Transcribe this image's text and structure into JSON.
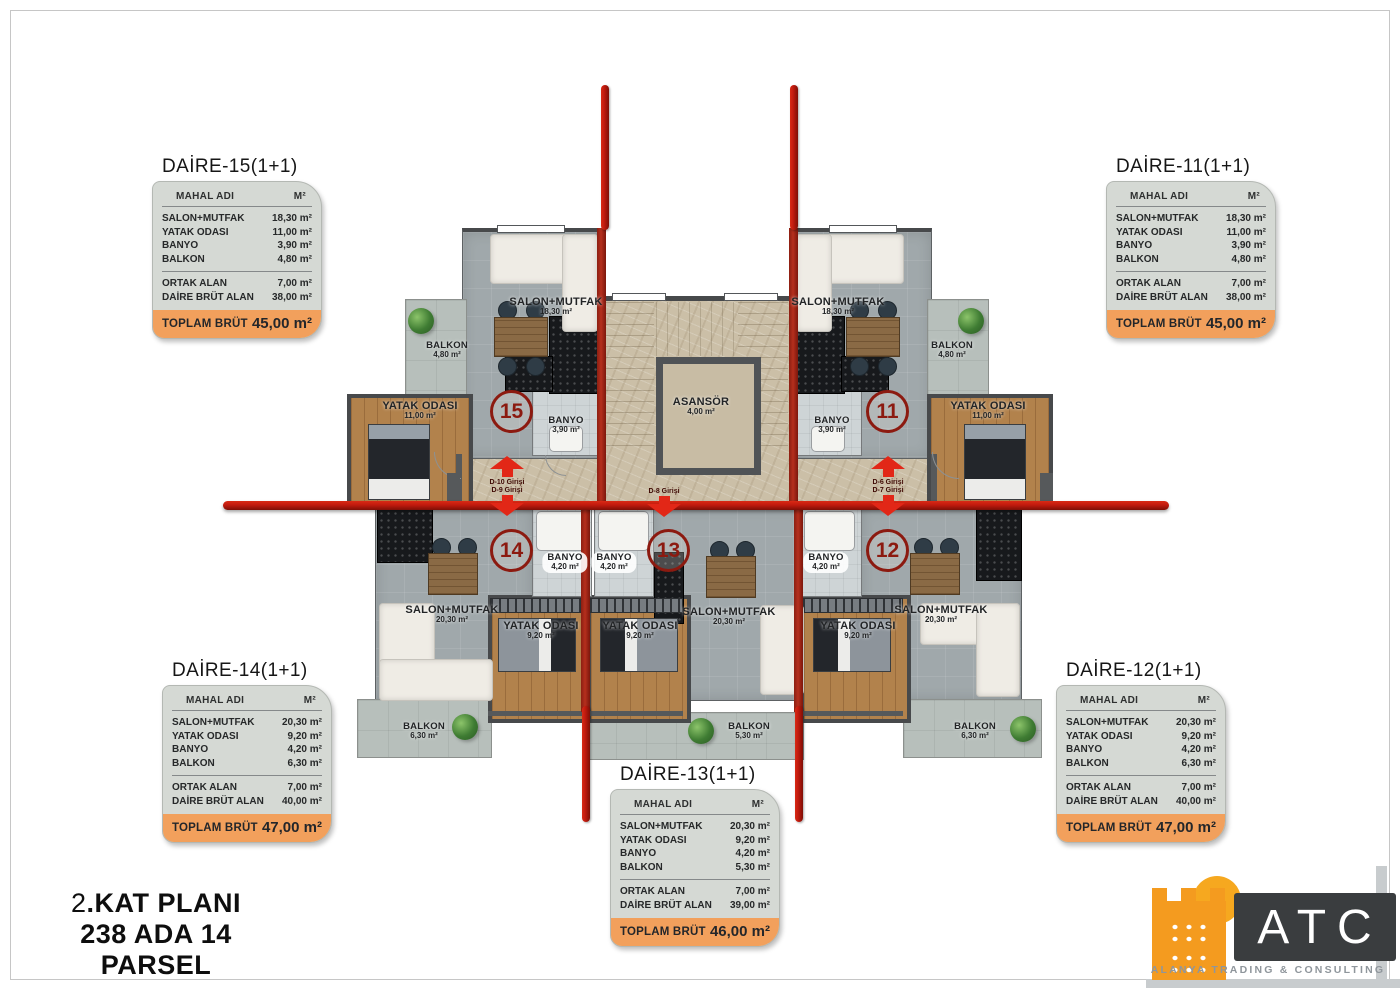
{
  "colors": {
    "section_line_red": "#c01a0e",
    "wall_red": "#a02418",
    "card_background": "#d5d9d4",
    "total_orange": "#f2a05c",
    "logo_orange": "#f49b1f",
    "logo_box_gray": "#3a3d3f",
    "badge_red": "#8c1a10"
  },
  "title_block": {
    "floor_number": "2",
    "floor_suffix": ".KAT PLANI",
    "parcel": "238 ADA 14 PARSEL"
  },
  "logo": {
    "name": "ATC",
    "tagline": "ALANYA TRADING & CONSULTING"
  },
  "tables": [
    {
      "title": "DAİRE-15(1+1)",
      "header_name": "MAHAL ADI",
      "header_unit": "M²",
      "rows": [
        {
          "label": "SALON+MUTFAK",
          "value": "18,30 m²"
        },
        {
          "label": "YATAK ODASI",
          "value": "11,00 m²"
        },
        {
          "label": "BANYO",
          "value": "3,90 m²"
        },
        {
          "label": "BALKON",
          "value": "4,80 m²"
        }
      ],
      "summary": [
        {
          "label": "ORTAK ALAN",
          "value": "7,00 m²"
        },
        {
          "label": "DAİRE BRÜT ALAN",
          "value": "38,00 m²"
        }
      ],
      "total_label": "TOPLAM BRÜT",
      "total_value": "45,00 m²"
    },
    {
      "title": "DAİRE-11(1+1)",
      "header_name": "MAHAL ADI",
      "header_unit": "M²",
      "rows": [
        {
          "label": "SALON+MUTFAK",
          "value": "18,30 m²"
        },
        {
          "label": "YATAK ODASI",
          "value": "11,00 m²"
        },
        {
          "label": "BANYO",
          "value": "3,90 m²"
        },
        {
          "label": "BALKON",
          "value": "4,80 m²"
        }
      ],
      "summary": [
        {
          "label": "ORTAK ALAN",
          "value": "7,00 m²"
        },
        {
          "label": "DAİRE BRÜT ALAN",
          "value": "38,00 m²"
        }
      ],
      "total_label": "TOPLAM BRÜT",
      "total_value": "45,00 m²"
    },
    {
      "title": "DAİRE-14(1+1)",
      "header_name": "MAHAL ADI",
      "header_unit": "M²",
      "rows": [
        {
          "label": "SALON+MUTFAK",
          "value": "20,30 m²"
        },
        {
          "label": "YATAK ODASI",
          "value": "9,20 m²"
        },
        {
          "label": "BANYO",
          "value": "4,20 m²"
        },
        {
          "label": "BALKON",
          "value": "6,30 m²"
        }
      ],
      "summary": [
        {
          "label": "ORTAK ALAN",
          "value": "7,00 m²"
        },
        {
          "label": "DAİRE BRÜT ALAN",
          "value": "40,00 m²"
        }
      ],
      "total_label": "TOPLAM BRÜT",
      "total_value": "47,00 m²"
    },
    {
      "title": "DAİRE-12(1+1)",
      "header_name": "MAHAL ADI",
      "header_unit": "M²",
      "rows": [
        {
          "label": "SALON+MUTFAK",
          "value": "20,30 m²"
        },
        {
          "label": "YATAK ODASI",
          "value": "9,20 m²"
        },
        {
          "label": "BANYO",
          "value": "4,20 m²"
        },
        {
          "label": "BALKON",
          "value": "6,30 m²"
        }
      ],
      "summary": [
        {
          "label": "ORTAK ALAN",
          "value": "7,00 m²"
        },
        {
          "label": "DAİRE BRÜT ALAN",
          "value": "40,00 m²"
        }
      ],
      "total_label": "TOPLAM BRÜT",
      "total_value": "47,00 m²"
    },
    {
      "title": "DAİRE-13(1+1)",
      "header_name": "MAHAL ADI",
      "header_unit": "M²",
      "rows": [
        {
          "label": "SALON+MUTFAK",
          "value": "20,30 m²"
        },
        {
          "label": "YATAK ODASI",
          "value": "9,20 m²"
        },
        {
          "label": "BANYO",
          "value": "4,20 m²"
        },
        {
          "label": "BALKON",
          "value": "5,30 m²"
        }
      ],
      "summary": [
        {
          "label": "ORTAK ALAN",
          "value": "7,00 m²"
        },
        {
          "label": "DAİRE BRÜT ALAN",
          "value": "39,00 m²"
        }
      ],
      "total_label": "TOPLAM BRÜT",
      "total_value": "46,00 m²"
    }
  ],
  "plan": {
    "units": [
      {
        "number": "15"
      },
      {
        "number": "11"
      },
      {
        "number": "14"
      },
      {
        "number": "13"
      },
      {
        "number": "12"
      }
    ],
    "rooms": [
      {
        "name": "BALKON",
        "area": "4,80 m²"
      },
      {
        "name": "SALON+MUTFAK",
        "area": "18,30 m²"
      },
      {
        "name": "YATAK ODASI",
        "area": "11,00 m²"
      },
      {
        "name": "BANYO",
        "area": "3,90 m²"
      },
      {
        "name": "SALON+MUTFAK",
        "area": "18,30 m²"
      },
      {
        "name": "BALKON",
        "area": "4,80 m²"
      },
      {
        "name": "YATAK ODASI",
        "area": "11,00 m²"
      },
      {
        "name": "BANYO",
        "area": "3,90 m²"
      },
      {
        "name": "ASANSÖR",
        "area": "4,00 m²"
      },
      {
        "name": "BANYO",
        "area": "4,20 m²"
      },
      {
        "name": "BANYO",
        "area": "4,20 m²"
      },
      {
        "name": "BANYO",
        "area": "4,20 m²"
      },
      {
        "name": "SALON+MUTFAK",
        "area": "20,30 m²"
      },
      {
        "name": "YATAK ODASI",
        "area": "9,20 m²"
      },
      {
        "name": "YATAK ODASI",
        "area": "9,20 m²"
      },
      {
        "name": "SALON+MUTFAK",
        "area": "20,30 m²"
      },
      {
        "name": "YATAK ODASI",
        "area": "9,20 m²"
      },
      {
        "name": "SALON+MUTFAK",
        "area": "20,30 m²"
      },
      {
        "name": "BALKON",
        "area": "6,30 m²"
      },
      {
        "name": "BALKON",
        "area": "5,30 m²"
      },
      {
        "name": "BALKON",
        "area": "6,30 m²"
      }
    ],
    "entrances": [
      {
        "label": "D-10 Girişi"
      },
      {
        "label": "D-9 Girişi"
      },
      {
        "label": "D-8 Girişi"
      },
      {
        "label": "D-6 Girişi"
      },
      {
        "label": "D-7 Girişi"
      }
    ]
  }
}
